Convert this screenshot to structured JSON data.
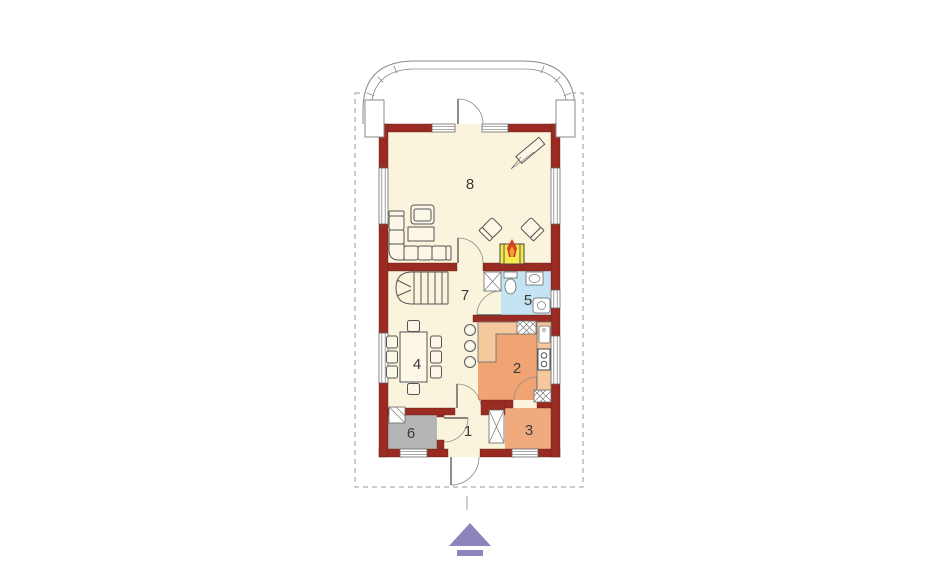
{
  "plan": {
    "type": "house-floor-plan",
    "rooms": {
      "r1": "1",
      "r2": "2",
      "r3": "3",
      "r4": "4",
      "r5": "5",
      "r6": "6",
      "r7": "7",
      "r8": "8"
    },
    "colors": {
      "wall": "#9A2B22",
      "floor": "#FBF4DD",
      "kitchen": "#F0A474",
      "pantry": "#F0AA7E",
      "bathroom": "#C4E4F4",
      "utility": "#B4B5B7",
      "counter": "#F6C89E",
      "fireplace": "#F6E94B",
      "flame": "#D8401F",
      "flame_inner": "#F0A23C",
      "logo": "#8C85BB",
      "boundary": "#9A9A9A"
    }
  }
}
